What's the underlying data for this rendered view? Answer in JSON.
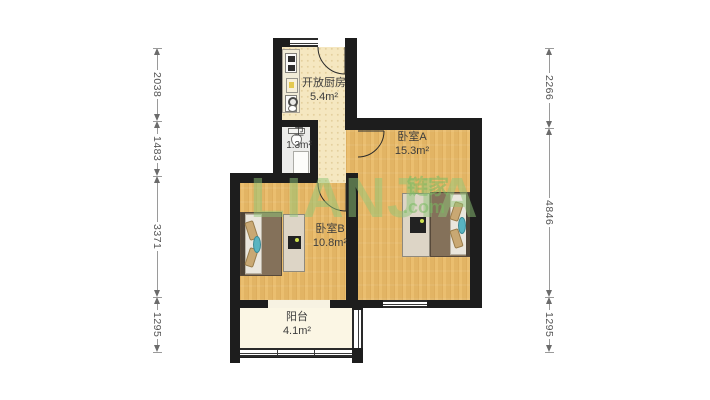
{
  "watermark": {
    "brand": "LIANJIA",
    "cn": "链家",
    "tld": ".com"
  },
  "rooms": [
    {
      "name": "开放厨房",
      "area": "5.4m²"
    },
    {
      "name": "卫",
      "area": "1.3m²"
    },
    {
      "name": "卧室A",
      "area": "15.3m²"
    },
    {
      "name": "卧室B",
      "area": "10.8m²"
    },
    {
      "name": "阳台",
      "area": "4.1m²"
    }
  ],
  "dimensions": {
    "left": [
      {
        "value": "2038"
      },
      {
        "value": "1483"
      },
      {
        "value": "3371"
      },
      {
        "value": "1295"
      }
    ],
    "right": [
      {
        "value": "2266"
      },
      {
        "value": "4846"
      },
      {
        "value": "1295"
      }
    ]
  },
  "icons": [
    "bed",
    "wardrobe",
    "tv",
    "stove",
    "cutting-board",
    "sink",
    "toilet",
    "shower",
    "door-arc",
    "window",
    "dimension-arrow"
  ],
  "colors": {
    "wall": "#1d1d1d",
    "wood_floor": "#e9ba67",
    "kitchen_floor": "#f5e7c0",
    "bath_floor": "#ececea",
    "balcony_floor": "#fbf6e4",
    "watermark_green": "#8fc671",
    "label_text": "#3d3d3d",
    "dimension_text": "#555555"
  }
}
